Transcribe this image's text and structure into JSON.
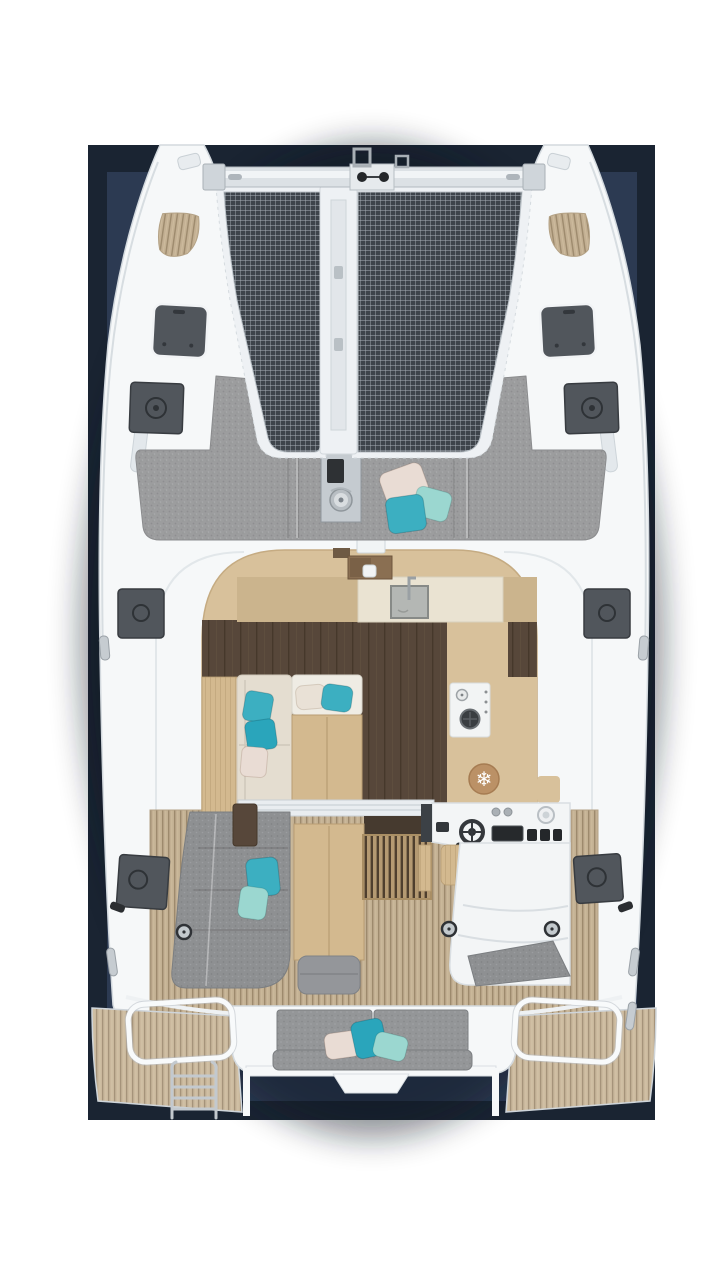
{
  "meta": {
    "content_type": "3d-rendered top-down deck and interior layout plan of a sailing catamaran",
    "view": "overhead / bird's-eye",
    "visible_text": "none"
  },
  "canvas": {
    "width": 722,
    "height": 1280
  },
  "photo_frame": {
    "outer_rect": {
      "x": 88,
      "y": 145,
      "w": 567,
      "h": 975
    },
    "inner_rect": {
      "x": 107,
      "y": 172,
      "w": 530,
      "h": 929
    }
  },
  "colors": {
    "bg_page": "#ffffff",
    "navy_outer": "#1a2432",
    "navy_inner": "#2c3a52",
    "hull": "#f6f8f9",
    "hull_edge": "#d3d9de",
    "beam": "#dce1e5",
    "beam_hi": "#f1f4f6",
    "beam_edge": "#b2b9bf",
    "steel": "#c5cbd0",
    "steel_dark": "#8f969c",
    "net_base": "#3e444b",
    "net_line": "#a9b1b8",
    "flange": "#eef1f4",
    "flange_edge": "#d5dbdf",
    "sunpad_gray": "#9c9d9e",
    "cushion_gray": "#8e9092",
    "cushion_dark": "#7b7e81",
    "bench_gray": "#949698",
    "hatch": "#51565c",
    "hatch_dark": "#383c41",
    "hatch_edge": "#f2f4f6",
    "teak": "#c3b093",
    "teak_gap": "#9d8a6d",
    "teak_light": "#cab89d",
    "walnut": "#57473a",
    "walnut_gap": "#46382b",
    "oak": "#d8c19b",
    "oak_mid": "#cbb48d",
    "oak_deep": "#8a6f52",
    "oak_table": "#d3b98f",
    "oak_edge": "#b89d73",
    "cream": "#eae3d2",
    "sofa_cream": "#e4ddd0",
    "berth_white": "#efece4",
    "counter_sink": "#b4b7b4",
    "sink_edge": "#878a87",
    "stove_white": "#f2f4f4",
    "burner_dark": "#3a3e41",
    "fridge_tan": "#bb9166",
    "fridge_edge": "#a67c52",
    "pillow_teal": "#3cafc1",
    "pillow_teal_deep": "#2aa5bb",
    "pillow_mint": "#9bd7d0",
    "pillow_blush": "#e9dcd4",
    "pillow_cream": "#e9e1d6",
    "console": "#f3f5f6",
    "console_edge": "#d9dee2",
    "screen": "#26292c",
    "black": "#24272a",
    "door_band": "#e9edf0",
    "door_slot": "#463a2f"
  },
  "icons": {
    "fridge_snowflake": "❄"
  },
  "scene": {
    "vessel": "twin-hull catamaran",
    "areas": [
      "port bow",
      "starboard bow",
      "forward crossbeam",
      "trampoline net port panel",
      "trampoline net starboard panel",
      "central walkway spine",
      "anchor windlass",
      "foredeck sun pad with three pillows",
      "deck window hatches",
      "deck vent hatches",
      "salon with galley",
      "galley sink",
      "two-burner stove",
      "fridge locker",
      "salon sofa with pillows",
      "forward berth cushion",
      "salon table",
      "cockpit sofa with pillows",
      "cockpit table and ottoman",
      "engine slat hatch",
      "helm station with wheel, display and compass",
      "helm seat",
      "corner seat pad",
      "aft bench with three pillows",
      "port swim platform",
      "starboard swim platform",
      "platform grab rails",
      "boarding ladder",
      "transom step"
    ],
    "pillow_count_total": 13
  }
}
